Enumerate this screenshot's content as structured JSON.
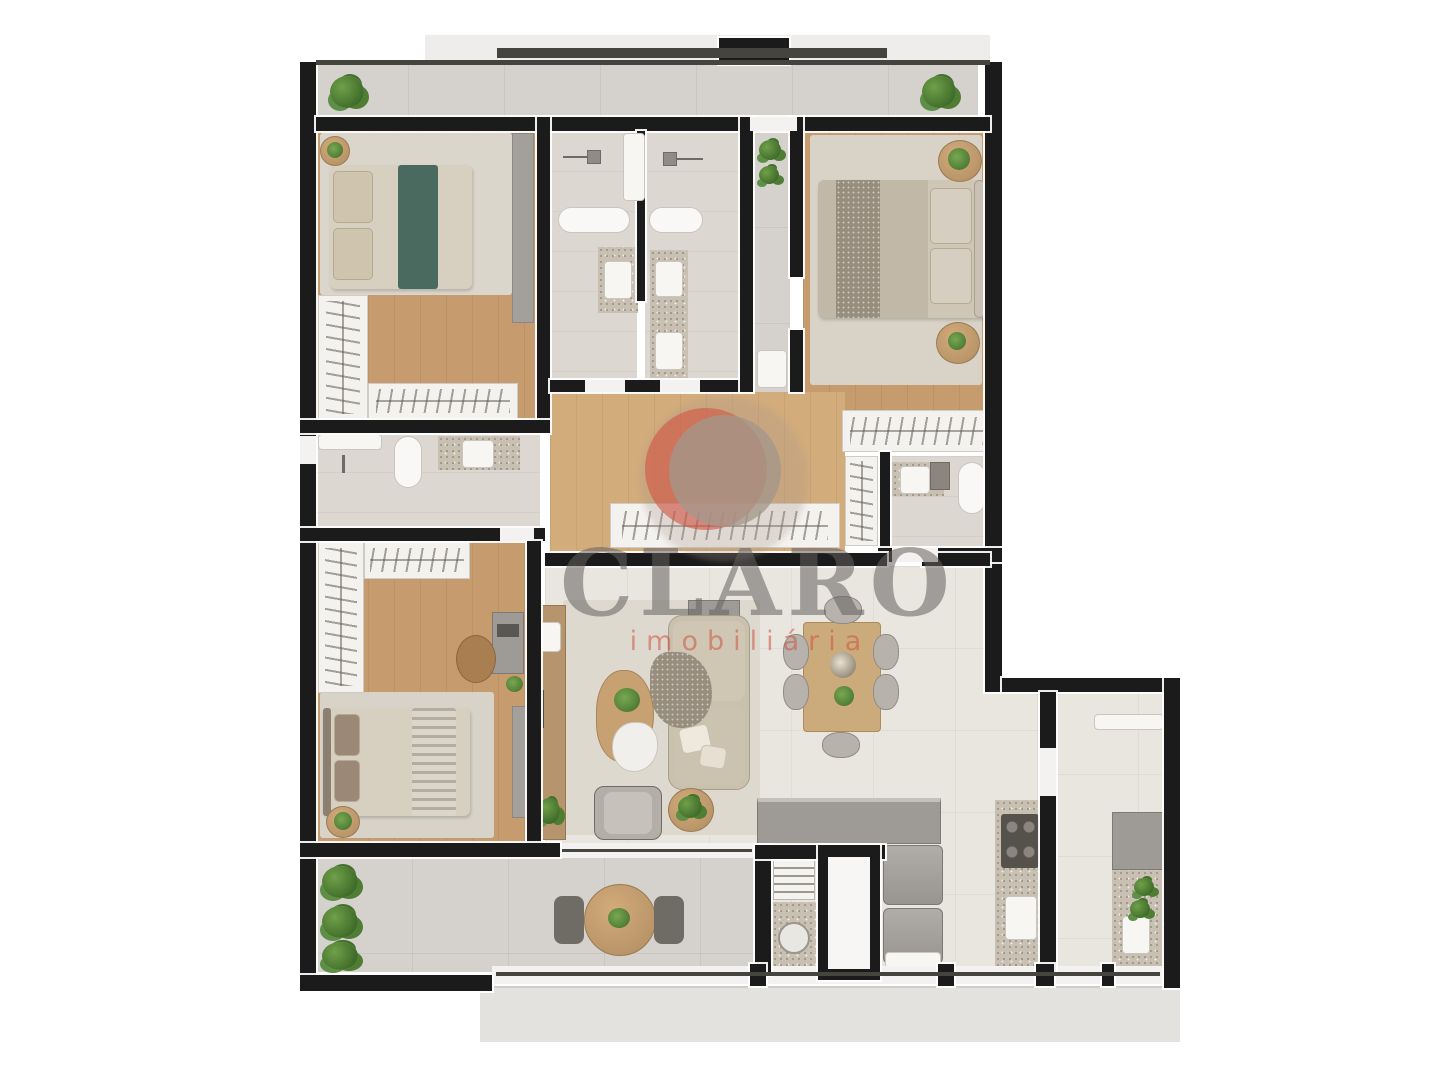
{
  "watermark": {
    "brand": "CLARO",
    "tagline": "imobiliária",
    "brand_color": "#64615e",
    "tagline_color": "#cd5240",
    "emblem": {
      "crescent_color": "#d25442",
      "disc_color": "#a49788"
    }
  },
  "colors": {
    "background": "#ffffff",
    "walls": "#1b1b1b",
    "wood_floor": "#c69b6d",
    "light_wood_floor": "#d3ac7c",
    "living_tile": "#e9e5df",
    "balcony_tile": "#d5d2ce",
    "bathroom_tile": "#dcd7d0",
    "granite_counter": "#c8c0b2",
    "rug": "#d9d4c9",
    "bed_linen": "#d7cfbf",
    "teal_runner": "#4b6a5f",
    "plants": "#4e7d33",
    "cabinets_gray": "#9e9b97",
    "closet_white": "#f4f2ef"
  },
  "floorplan": {
    "type": "residential-apartment-top-view-render",
    "rooms": [
      "upper-terrace",
      "bedroom-1",
      "bathroom-1",
      "bathroom-2",
      "entry-foyer",
      "master-bedroom",
      "master-closet",
      "master-bathroom",
      "walk-in-hall-closet",
      "bathroom-3",
      "bedroom-2",
      "living-room",
      "dining-area",
      "kitchen",
      "laundry",
      "service-terrace",
      "balcony"
    ],
    "furniture": [
      "double-bed-teal-runner",
      "double-bed-master",
      "single-bed-striped",
      "wardrobes-with-hangers",
      "shoe-shelves",
      "desk-with-monitor",
      "l-shaped-sofa",
      "armchair",
      "coffee-tables",
      "tv-console",
      "dining-table-6-chairs",
      "round-balcony-table-2-chairs",
      "cooktop",
      "kitchen-sinks",
      "laundry-tub",
      "washer-dryer-stack",
      "toilets",
      "vanity-sinks",
      "shower-heads",
      "potted-plants",
      "hedge-plants"
    ]
  }
}
